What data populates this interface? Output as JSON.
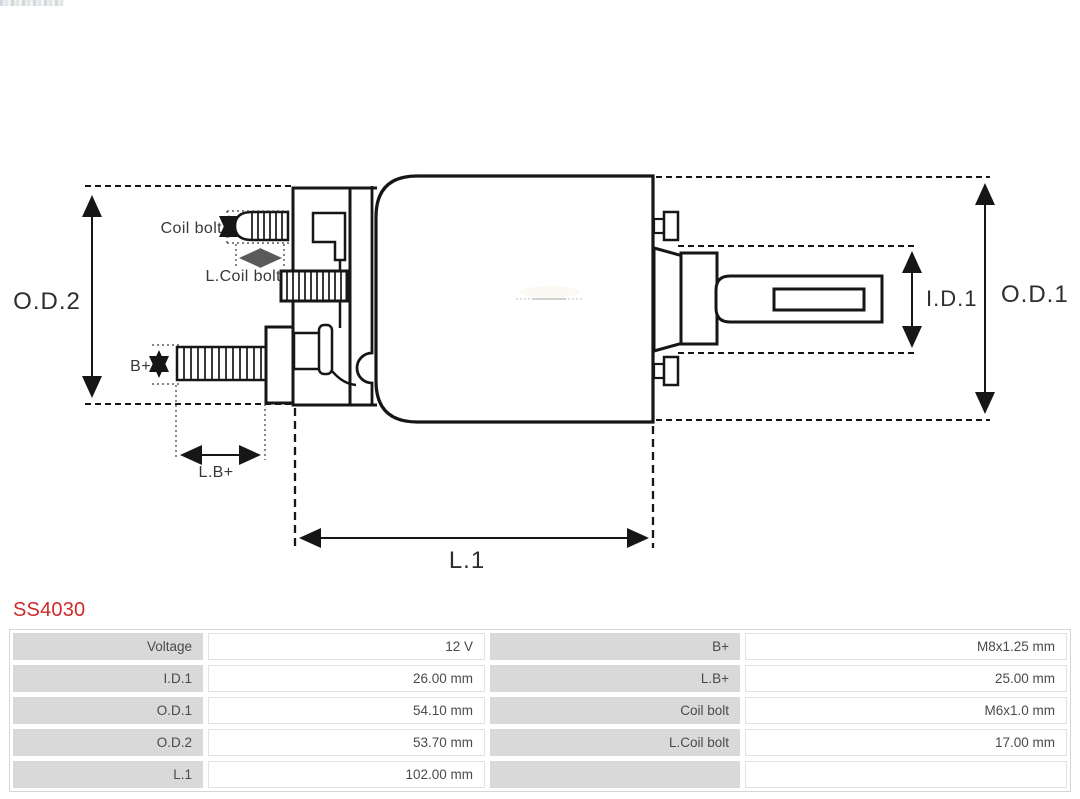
{
  "title": "SS4030",
  "colors": {
    "accent_red": "#cf2b2b",
    "table_label_bg": "#d9d9d9",
    "drawing_line": "#161616",
    "table_text": "#4a4a4a"
  },
  "diagram": {
    "labels": {
      "od2": "O.D.2",
      "od1": "O.D.1",
      "id1": "I.D.1",
      "l1": "L.1",
      "lb_plus": "L.B+",
      "b_plus": "B+",
      "coil_bolt": "Coil bolt",
      "l_coil_bolt": "L.Coil bolt"
    }
  },
  "specs": {
    "rows": [
      {
        "l1": "Voltage",
        "v1": "12 V",
        "l2": "B+",
        "v2": "M8x1.25 mm"
      },
      {
        "l1": "I.D.1",
        "v1": "26.00 mm",
        "l2": "L.B+",
        "v2": "25.00 mm"
      },
      {
        "l1": "O.D.1",
        "v1": "54.10 mm",
        "l2": "Coil bolt",
        "v2": "M6x1.0 mm"
      },
      {
        "l1": "O.D.2",
        "v1": "53.70 mm",
        "l2": "L.Coil bolt",
        "v2": "17.00 mm"
      },
      {
        "l1": "L.1",
        "v1": "102.00 mm",
        "l2": "",
        "v2": ""
      }
    ]
  }
}
